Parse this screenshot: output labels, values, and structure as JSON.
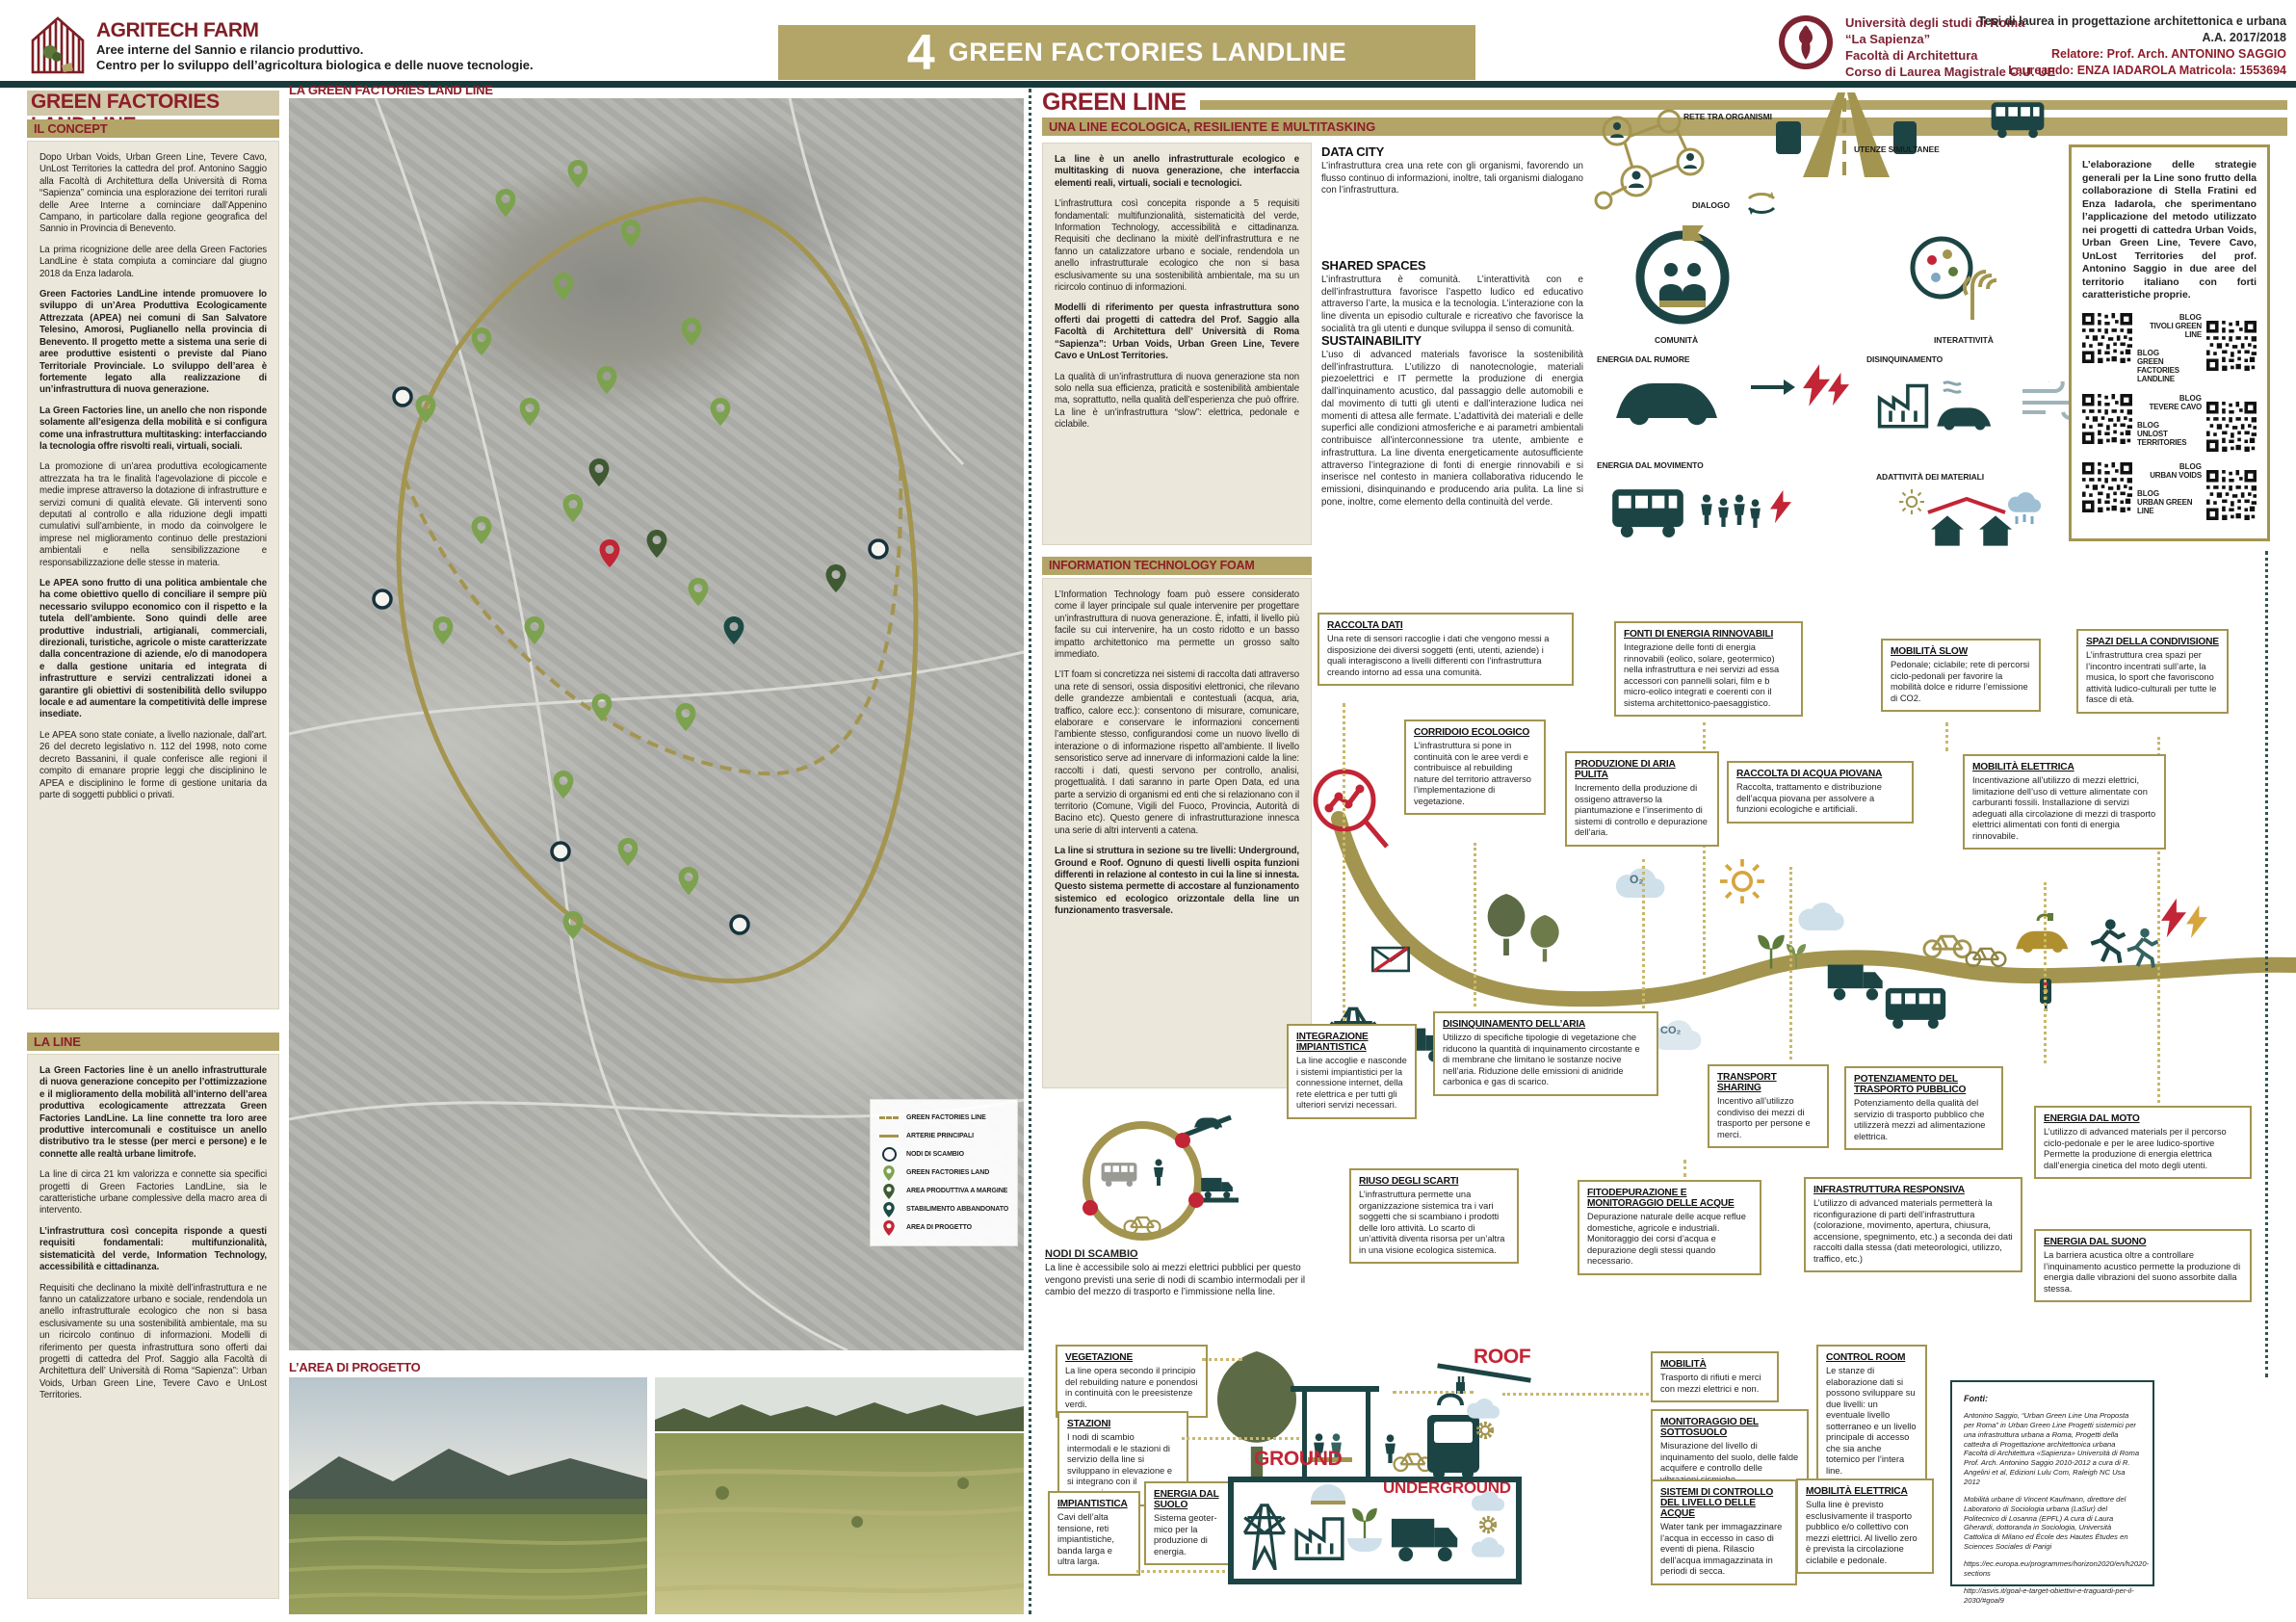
{
  "header": {
    "logo_title": "AGRITECH FARM",
    "logo_sub1": "Aree interne del Sannio e rilancio produttivo.",
    "logo_sub2": "Centro per lo sviluppo dell’agricoltura biologica e delle nuove tecnologie.",
    "banner_number": "4",
    "banner_title": "GREEN FACTORIES LANDLINE",
    "uni_line1": "Università degli studi di Roma",
    "uni_line2": "“La Sapienza”",
    "uni_line3": "Facoltà di Architettura",
    "uni_line4": "Corso di Laurea Magistrale C.U. UE",
    "thesis_line1": "Tesi di laurea in progettazione architettonica e urbana",
    "thesis_line2": "A.A. 2017/2018",
    "thesis_line3": "Relatore: Prof. Arch. ANTONINO SAGGIO",
    "thesis_line4": "Laureando: ENZA IADAROLA  Matricola: 1553694"
  },
  "left": {
    "title": "GREEN FACTORIES LAND LINE",
    "concept": {
      "heading": "IL CONCEPT",
      "paragraphs": [
        "Dopo Urban Voids, Urban Green Line, Tevere Cavo, UnLost Territories la cattedra del prof. Antonino Saggio alla Facoltà di Architettura della Università di Roma “Sapienza” comincia una esplorazione dei territori rurali delle Aree Interne a cominciare dall’Appenino Campano, in particolare dalla regione geografica del Sannio in Provincia di Benevento.",
        "La prima ricognizione delle aree della Green Factories LandLine è stata compiuta a cominciare dal giugno 2018 da Enza Iadarola.",
        "Green Factories LandLine intende promuovere lo sviluppo di un’Area Produttiva Ecologicamente Attrezzata (APEA) nei comuni di San Salvatore Telesino, Amorosi, Puglianello nella provincia di Benevento. Il progetto mette a sistema una serie di aree produttive esistenti o previste dal Piano Territoriale Provinciale. Lo sviluppo dell’area è fortemente legato alla realizzazione di un’infrastruttura di nuova generazione.",
        "La Green Factories line, un anello che non risponde solamente all’esigenza della mobilità e si configura come una infrastruttura multitasking: interfacciando la tecnologia offre risvolti reali, virtuali, sociali.",
        "La promozione di un’area produttiva ecologicamente attrezzata ha tra le finalità l’agevolazione di piccole e medie imprese attraverso la dotazione di infrastrutture e servizi comuni di qualità elevate. Gli interventi sono deputati al controllo e alla riduzione degli impatti cumulativi sull’ambiente, in modo da coinvolgere le imprese nel miglioramento continuo delle prestazioni ambientali e nella sensibilizzazione e responsabilizzazione delle stesse in materia.",
        "Le APEA sono frutto di una politica ambientale che ha come obiettivo quello di conciliare il sempre più necessario sviluppo economico con il rispetto e la tutela dell’ambiente. Sono quindi delle aree produttive industriali, artigianali, commerciali, direzionali, turistiche, agricole o miste caratterizzate dalla concentrazione di aziende, e/o di manodopera e dalla gestione unitaria ed integrata di infrastrutture e servizi centralizzati idonei a garantire gli obiettivi di sostenibilità dello sviluppo locale e ad aumentare la competitività delle imprese insediate.",
        "Le APEA sono state coniate, a livello nazionale, dall’art. 26 del decreto legislativo n. 112 del 1998, noto come decreto Bassanini, il quale conferisce alle regioni il compito di emanare proprie leggi che disciplinino le APEA e disciplinino le forme di gestione unitaria da parte di soggetti pubblici o privati."
      ]
    },
    "laline": {
      "heading": "LA LINE",
      "paragraphs": [
        "La Green Factories line è un anello infrastrutturale di nuova generazione concepito per l’ottimizzazione e il miglioramento della mobilità all’interno dell’area produttiva ecologicamente attrezzata Green Factories LandLine. La line connette tra loro aree produttive intercomunali e costituisce un anello distributivo tra le stesse (per merci e persone) e le connette alle realtà urbane limitrofe.",
        "La line di circa 21 km valorizza e connette sia specifici progetti di Green Factories LandLine, sia le caratteristiche urbane complessive della macro area di intervento.",
        "L’infrastruttura così concepita risponde a questi requisiti fondamentali: multifunzionalità, sistematicità del verde, Information Technology, accessibilità e cittadinanza.",
        "Requisiti che declinano la mixitè dell’infrastruttura e ne fanno un catalizzatore urbano e sociale, rendendola un anello infrastrutturale ecologico che non si basa esclusivamente su una sostenibilità ambientale, ma su un ricircolo continuo di informazioni. Modelli di riferimento per questa infrastruttura sono offerti dai progetti di cattedra del Prof. Saggio alla Facoltà di Architettura dell’ Università di Roma “Sapienza”: Urban Voids, Urban Green Line, Tevere Cavo e UnLost Territories."
      ]
    }
  },
  "map": {
    "title": "LA GREEN FACTORIES LAND LINE",
    "legend": [
      {
        "label": "GREEN FACTORIES LINE"
      },
      {
        "label": "ARTERIE PRINCIPALI"
      },
      {
        "label": "NODI DI SCAMBIO"
      },
      {
        "label": "GREEN FACTORIES LAND"
      },
      {
        "label": "AREA PRODUTTIVA A MARGINE"
      },
      {
        "label": "STABILIMENTO ABBANDONATO"
      },
      {
        "label": "AREA DI PROGETTO"
      }
    ],
    "photos_heading": "L’AREA DI PROGETTO"
  },
  "green_line": {
    "title": "GREEN LINE",
    "subtitle": "UNA LINE ECOLOGICA, RESILIENTE E MULTITASKING",
    "intro": [
      "La line è un anello infrastrutturale ecologico e multitasking di nuova generazione, che interfaccia elementi reali, virtuali, sociali e tecnologici.",
      "L’infrastruttura così concepita risponde a 5 requisiti fondamentali: multifunzionalità, sistematicità del verde, Information Technology, accessibilità e cittadinanza. Requisiti che declinano la mixitè dell’infrastruttura e ne fanno un catalizzatore urbano e sociale, rendendola un anello infrastrutturale ecologico che non si basa esclusivamente su una sostenibilità ambientale, ma su un ricircolo continuo di informazioni.",
      "Modelli di riferimento per questa infrastruttura sono  offerti dai progetti di cattedra del Prof. Saggio alla Facoltà di Architettura dell’ Università di Roma “Sapienza”: Urban Voids, Urban Green Line, Tevere Cavo e UnLost Territories.",
      "La qualità di un’infrastruttura di nuova generazione sta non solo nella sua efficienza, praticità e sostenibilità ambientale ma, soprattutto, nella qualità dell’esperienza che può offrire.  La line è un’infrastruttura “slow”: elettrica, pedonale e ciclabile."
    ],
    "columns": [
      {
        "heading": "DATA CITY",
        "text": "L’infrastruttura crea una rete con gli organismi, favorendo un flusso continuo di informazioni, inoltre, tali organismi dialogano con l’infrastruttura."
      },
      {
        "heading": "SHARED SPACES",
        "text": "L’infrastruttura è comunità. L’interattività con e dell’infrastruttura favorisce l’aspetto ludico ed educativo attraverso l’arte, la musica e la tecnologia. L’interazione con la line diventa un episodio culturale e ricreativo che favorisce la socialità tra gli utenti e dunque sviluppa il senso di comunità."
      },
      {
        "heading": "SUSTAINABILITY",
        "text": "L’uso di advanced materials favorisce la sostenibilità dell’infrastruttura. L’utilizzo di nanotecnologie, materiali piezoelettrici e IT permette la produzione di energia dall’inquinamento acustico, dal passaggio delle automobili e dal movimento di tutti gli utenti e dall’interazione ludica nei momenti di attesa alle fermate. L’adattività dei materiali e delle superfici alle condizioni atmosferiche e ai parametri ambientali contribuisce all’interconnessione tra utente, ambiente e infrastruttura. La line diventa energeticamente autosufficiente attraverso l’integrazione di  fonti di energie rinnovabili e si inserisce nel contesto in maniera collaborativa riducendo le emissioni, disinquinando e producendo aria pulita. La line si pone, inoltre, come elemento della continuità del verde."
      }
    ],
    "icon_labels": {
      "rete": "RETE TRA ORGANISMI",
      "dialogo": "DIALOGO",
      "utenze": "UTENZE SIMULTANEE",
      "comunita": "COMUNITÀ",
      "interattivita": "INTERATTIVITÀ",
      "rumore": "ENERGIA DAL RUMORE",
      "disinquinamento": "DISINQUINAMENTO",
      "movimento": "ENERGIA DAL MOVIMENTO",
      "adattivita": "ADATTIVITÀ DEI MATERIALI",
      "o2": "O₂"
    },
    "strategy": {
      "text": "L’elaborazione delle strategie generali per la Line sono frutto della collaborazione di Stella Fratini ed Enza Iadarola, che sperimentano l’applicazione del metodo utilizzato nei progetti di cattedra Urban Voids, Urban Green Line, Tevere Cavo, UnLost Territories del prof. Antonino Saggio in due aree del territorio italiano con forti caratteristiche proprie.",
      "blog": "BLOG",
      "qr": [
        {
          "top": "TIVOLI GREEN LINE",
          "bottom": "GREEN FACTORIES LANDLINE"
        },
        {
          "top": "TEVERE CAVO",
          "bottom": "UNLOST TERRITORIES"
        },
        {
          "top": "URBAN VOIDS",
          "bottom": "URBAN GREEN LINE"
        }
      ]
    }
  },
  "itfoam": {
    "heading": "INFORMATION TECHNOLOGY FOAM",
    "paragraphs": [
      "L’Information Technology foam può essere considerato come il layer principale sul quale intervenire per progettare un’infrastruttura di nuova generazione. È, infatti, il livello più facile su cui intervenire, ha un costo ridotto e un basso impatto architettonico ma permette un grosso salto immediato.",
      "L’IT foam si concretizza nei sistemi di raccolta dati attraverso una rete di sensori, ossia dispositivi elettronici, che rilevano delle grandezze ambientali e contestuali (acqua, aria, traffico, calore ecc.): consentono di misurare, comunicare, elaborare e conservare le informazioni concernenti l’ambiente stesso, configurandosi come un nuovo livello di interazione o di informazione rispetto all’ambiente. Il livello sensoristico serve ad innervare di informazioni calde la line: raccolti i dati, questi servono per controllo, analisi, progettualità. I dati saranno in parte Open Data, ed una parte a servizio di organismi ed enti che si relazionano con il territorio (Comune, Vigili del Fuoco, Provincia, Autorità di Bacino etc). Questo genere di infrastrutturazione innesca una serie di altri interventi a catena.",
      "La line si struttura in sezione su tre livelli: Underground, Ground e Roof. Ognuno di questi livelli ospita funzioni differenti in relazione al contesto in cui la line si innesta. Questo sistema permette di accostare al funzionamento sistemico ed ecologico orizzontale della line un funzionamento trasversale."
    ]
  },
  "annotations": {
    "raccolta_dati": {
      "title": "RACCOLTA DATI",
      "text": "Una rete di sensori raccoglie i dati che vengono messi a disposizione dei diversi soggetti (enti, utenti, aziende) i quali interagiscono a livelli differenti con l’infrastruttura creando intorno ad essa una comunità."
    },
    "fonti_energia": {
      "title": "FONTI DI ENERGIA RINNOVABILI",
      "text": "Integrazione delle fonti di energia rinnovabili (eolico, solare, geotermico) nella infrastruttura e nei servizi ad essa accessori con pannelli solari, film e b micro-eolico integrati e coerenti con il sistema architettonico-paesaggistico."
    },
    "mobilita_slow": {
      "title": "MOBILITÀ SLOW",
      "text": "Pedonale; ciclabile; rete di percorsi ciclo-pedonali per favorire la mobilità dolce e ridurre l’emissione di CO2."
    },
    "spazi": {
      "title": "SPAZI DELLA CONDIVISIONE",
      "text": "L’infrastruttura crea spazi per l’incontro incentrati sull’arte, la musica, lo sport che favoriscono attività ludico-culturali per tutte le fasce di età."
    },
    "corridoio": {
      "title": "CORRIDOIO ECOLOGICO",
      "text": "L’infrastruttura si pone in continuità con le aree verdi e contribuisce al rebuilding nature del territorio attraverso l’implementazione di vegetazione."
    },
    "aria_pulita": {
      "title": "PRODUZIONE DI ARIA PULITA",
      "text": "Incremento della produzione di ossigeno attraverso la piantumazione e l’inserimento di sistemi di controllo e depurazione dell’aria."
    },
    "acqua_piovana": {
      "title": "RACCOLTA DI ACQUA PIOVANA",
      "text": "Raccolta, trattamento e distribuzione dell’acqua piovana per assolvere a funzioni ecologiche e artificiali."
    },
    "mobilita_elettrica": {
      "title": "MOBILITÀ ELETTRICA",
      "text": "Incentivazione all’utilizzo di mezzi elettrici, limitazione dell’uso di vetture alimentate con carburanti fossili. Installazione di servizi adeguati alla circolazione di mezzi di trasporto elettrici alimentati con fonti di energia rinnovabile."
    },
    "integrazione": {
      "title": "INTEGRAZIONE IMPIANTISTICA",
      "text": "La line accoglie e nasconde i sistemi impiantistici per la connessione internet, della rete elettrica e per tutti gli ulteriori servizi necessari."
    },
    "disinq_aria": {
      "title": "DISINQUINAMENTO DELL’ARIA",
      "text": "Utilizzo di specifiche tipologie di vegetazione  che riducono la quantità di inquinamento circostante e di membrane che limitano le sostanze nocive  nell’aria. Riduzione delle  emissioni di anidride carbonica e gas di scarico."
    },
    "riuso": {
      "title": "RIUSO DEGLI SCARTI",
      "text": "L’infrastruttura permette una organizzazione sistemica tra i vari soggetti che si scambiano i prodotti delle loro attività. Lo scarto di un’attività diventa risorsa per un’altra in una visione ecologica sistemica."
    },
    "fitodepurazione": {
      "title": "FITODEPURAZIONE E MONITORAGGIO DELLE ACQUE",
      "text": "Depurazione naturale delle acque reflue domestiche, agricole e industriali. Monitoraggio dei corsi d’acqua e depurazione degli stessi  quando necessario."
    },
    "transport_sharing": {
      "title": "TRANSPORT SHARING",
      "text": "Incentivo all’utilizzo condiviso dei mezzi di trasporto per persone e merci."
    },
    "potenziamento": {
      "title": "POTENZIAMENTO DEL TRASPORTO PUBBLICO",
      "text": "Potenziamento della qualità del servizio di trasporto pubblico che utilizzerà mezzi ad alimentazione elettrica."
    },
    "infra_responsiva": {
      "title": "INFRASTRUTTURA RESPONSIVA",
      "text": "L’utilizzo di advanced materials permetterà la riconfigurazione di parti dell’infrastruttura (colorazione, movimento, apertura, chiusura, accensione, spegnimento, etc.) a seconda dei dati raccolti dalla stessa (dati meteorologici, utilizzo, traffico, etc.)"
    },
    "energia_moto": {
      "title": "ENERGIA DAL MOTO",
      "text": "L’utilizzo di advanced materials per il percorso ciclo-pedonale e per le aree  ludico-sportive Permette la produzione di energia elettrica dall’energia cinetica del moto degli utenti."
    },
    "energia_suono": {
      "title": "ENERGIA DAL SUONO",
      "text": "La barriera acustica oltre a controllare l’inquinamento acustico permette la produzione di energia dalle vibrazioni del suono assorbite dalla stessa."
    },
    "nodi": {
      "title": "NODI DI SCAMBIO",
      "text": "La line è accessibile solo ai mezzi elettrici pubblici per questo vengono previsti una serie di nodi di scambio intermodali per il cambio del mezzo di trasporto e l’immissione nella line."
    }
  },
  "section": {
    "labels": {
      "roof": "ROOF",
      "ground": "GROUND",
      "underground": "UNDERGROUND"
    },
    "vegetazione": {
      "title": "VEGETAZIONE",
      "text": "La line opera secondo il principio del rebuilding nature e ponendosi in continuità con le preesistenze verdi."
    },
    "stazioni": {
      "title": "STAZIONI",
      "text": "I nodi di scambio intermodali e le stazioni di servizio della line si sviluppano in elevazione e si integrano con il paesaggio."
    },
    "impiantistica": {
      "title": "IMPIANTISTICA",
      "text": "Cavi dell’alta tensione, reti impiantistiche, banda larga e ultra larga."
    },
    "energia_suolo": {
      "title": "ENERGIA DAL SUOLO",
      "text": "Sistema geoter-mico per la produzione di energia."
    },
    "mobilita": {
      "title": "MOBILITÀ",
      "text": "Trasporto di rifiuti e merci con mezzi elettrici e non."
    },
    "monitoraggio": {
      "title": "MONITORAGGIO DEL SOTTOSUOLO",
      "text": "Misurazione del livello di inquinamento del suolo, delle falde acquifere e controllo delle vibrazioni sismiche."
    },
    "sistemi_acque": {
      "title": "SISTEMI DI CONTROLLO DEL LIVELLO DELLE ACQUE",
      "text": "Water tank per immagazzinare l’acqua in eccesso in caso di eventi di piena. Rilascio dell’acqua immagazzinata in periodi di secca."
    },
    "control_room": {
      "title": "CONTROL ROOM",
      "text": "Le stanze di elaborazione dati si possono sviluppare su due livelli: un eventuale livello sotterraneo e un livello principale di accesso che sia anche totemico per l’intera line."
    },
    "mobilita_el2": {
      "title": "MOBILITÀ ELETTRICA",
      "text": "Sulla line è previsto esclusivamente il trasporto pubblico e/o collettivo con mezzi elettrici. Al livello zero è prevista la circolazione ciclabile e pedonale."
    }
  },
  "gas": {
    "o2": "O₂",
    "co2": "CO₂",
    "o3": "O₃"
  },
  "fonti": {
    "heading": "Fonti:",
    "items": [
      "Antonino Saggio, “Urban Green Line Una Proposta per Roma” in Urban Green Line Progetti sistemici per una infrastruttura urbana a Roma, Progetti della cattedra di Progettazione architettonica urbana Facoltà di Architettura «Sapienza» Università di Roma Prof. Arch. Antonino Saggio 2010-2012 a cura di R. Angelini et al, Edizioni Lulu Com, Raleigh NC Usa 2012",
      "Mobilità urbane di Vincent Kaufmann, direttore del Laboratorio di Sociologia urbana (LaSur) del Politecnico di Losanna (EPFL) A cura di Laura Gherardi, dottoranda in Sociologia, Università Cattolica di Milano ed École des Hautes Études en Sciences Sociales di Parigi",
      "https://ec.europa.eu/programmes/horizon2020/en/h2020-sections",
      "http://asvis.it/goal-e-target-obiettivi-e-traguardi-per-il-2030/#goal9"
    ]
  },
  "colors": {
    "maroon": "#8e1d2a",
    "khaki": "#b3a468",
    "teal": "#1d4444",
    "gold": "#a3954f",
    "red": "#c22535"
  }
}
